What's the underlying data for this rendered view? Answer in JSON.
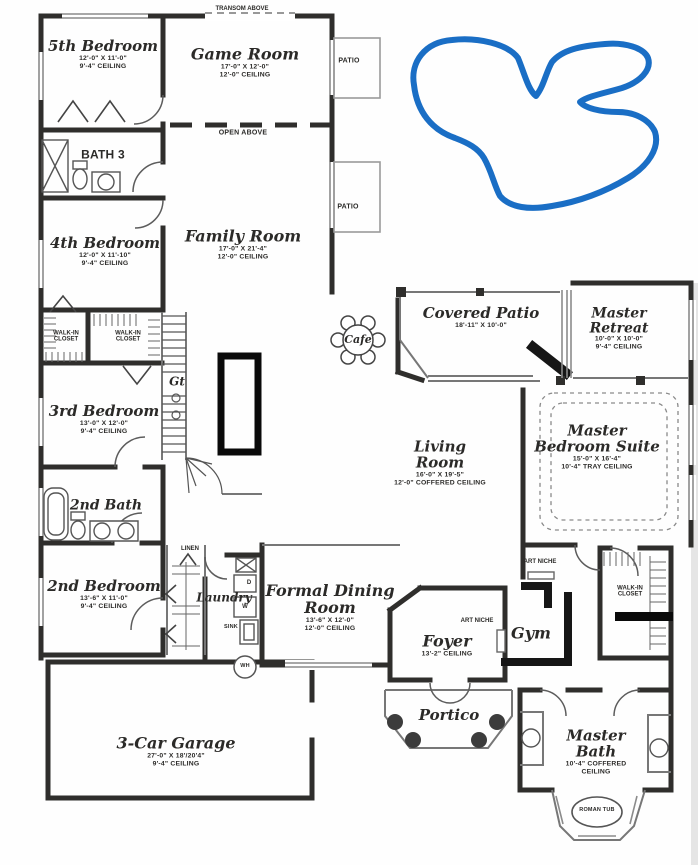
{
  "meta": {
    "doc_type": "residential floor plan",
    "wall_color": "#2f2e2c",
    "blue_marker_color": "#1a6ec5",
    "black_marker_color": "#0a0a0a"
  },
  "notes": {
    "transom": "TRANSOM ABOVE",
    "open_above": "OPEN ABOVE",
    "patio_a": "PATIO",
    "patio_b": "PATIO",
    "linen": "LINEN",
    "sink": "SINK",
    "wh": "WH",
    "washer": "W",
    "dryer": "D",
    "stair_text": "Gt",
    "art_niche_a": "ART NICHE",
    "art_niche_b": "ART NICHE",
    "roman_tub": "ROMAN TUB"
  },
  "rooms": {
    "bedroom5": {
      "name": "5th Bedroom",
      "dims": "12'-0\" X 11'-0\"",
      "ceiling": "9'-4\" CEILING"
    },
    "game_room": {
      "name": "Game Room",
      "dims": "17'-0\" X 12'-0\"",
      "ceiling": "12'-0\" CEILING"
    },
    "bath3": {
      "name": "BATH 3"
    },
    "bedroom4": {
      "name": "4th Bedroom",
      "dims": "12'-0\" X 11'-10\"",
      "ceiling": "9'-4\" CEILING"
    },
    "family_room": {
      "name": "Family Room",
      "dims": "17'-0\" X 21'-4\"",
      "ceiling": "12'-0\" CEILING"
    },
    "covered_patio": {
      "name": "Covered Patio",
      "dims": "18'-11\" X 10'-0\""
    },
    "master_retreat": {
      "name": "Master Retreat",
      "dims": "10'-0\" X 10'-0\"",
      "ceiling": "9'-4\" CEILING"
    },
    "cafe": {
      "name": "Cafe"
    },
    "walkin_a": {
      "name": "WALK-IN CLOSET"
    },
    "walkin_b": {
      "name": "WALK-IN CLOSET"
    },
    "bedroom3": {
      "name": "3rd Bedroom",
      "dims": "13'-0\" X 12'-0\"",
      "ceiling": "9'-4\" CEILING"
    },
    "master_suite": {
      "name": "Master Bedroom Suite",
      "dims": "15'-0\" X 16'-4\"",
      "ceiling": "10'-4\" TRAY CEILING"
    },
    "living_room": {
      "name": "Living Room",
      "dims": "16'-0\" X 19'-5\"",
      "ceiling": "12'-0\" COFFERED CEILING"
    },
    "bath2": {
      "name": "2nd Bath"
    },
    "bedroom2": {
      "name": "2nd Bedroom",
      "dims": "13'-6\" X 11'-0\"",
      "ceiling": "9'-4\" CEILING"
    },
    "laundry": {
      "name": "Laundry"
    },
    "formal_dining": {
      "name": "Formal Dining Room",
      "dims": "13'-6\" X 12'-0\"",
      "ceiling": "12'-0\" CEILING"
    },
    "foyer": {
      "name": "Foyer",
      "ceiling": "13'-2\" CEILING"
    },
    "gym": {
      "name": "Gym"
    },
    "walkin_master": {
      "name": "WALK-IN CLOSET"
    },
    "portico": {
      "name": "Portico"
    },
    "garage": {
      "name": "3-Car Garage",
      "dims": "27'-0\" X 18'/20'4\"",
      "ceiling": "9'-4\" CEILING"
    },
    "master_bath": {
      "name": "Master Bath",
      "ceiling": "10'-4\" COFFERED CEILING"
    }
  }
}
